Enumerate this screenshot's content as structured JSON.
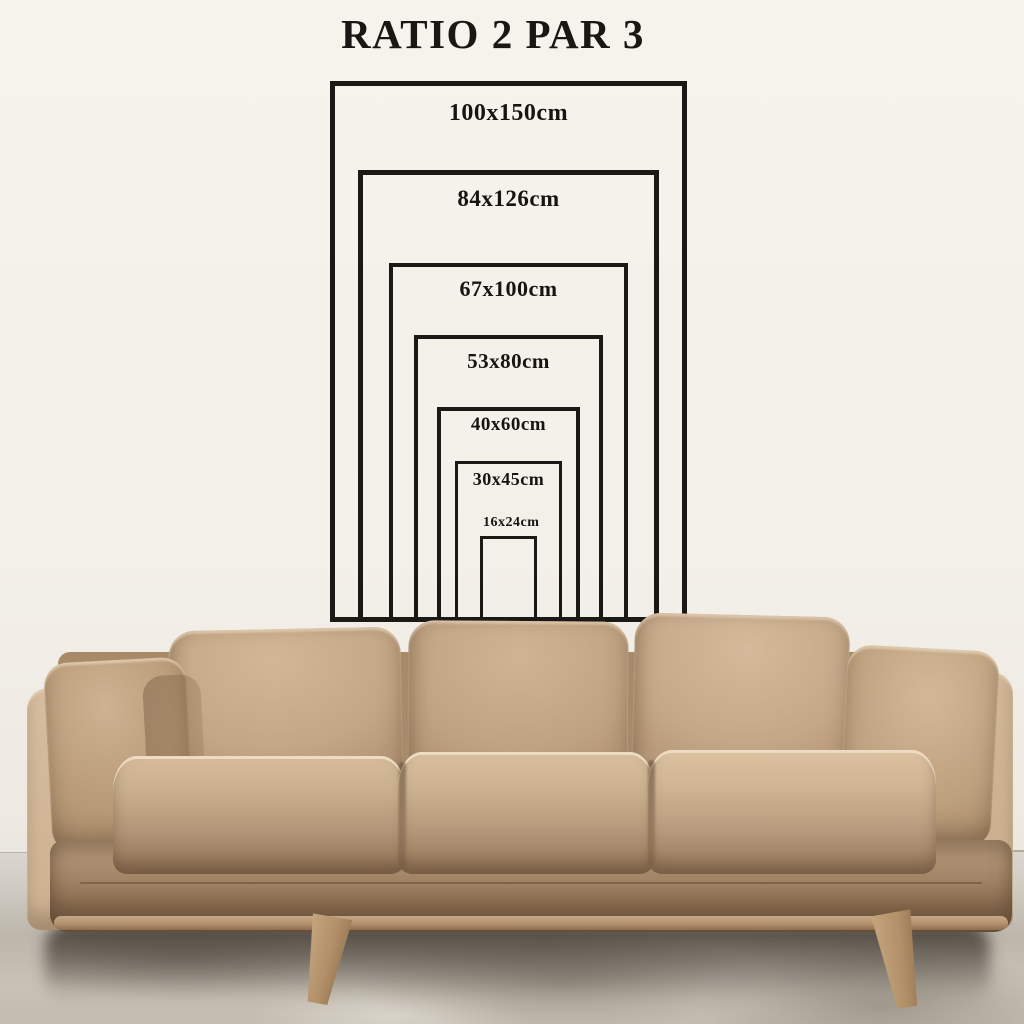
{
  "title": "RATIO 2 PAR 3",
  "diagram": {
    "unit": "cm",
    "aspect_ratio": "2:3",
    "line_color": "#1b1916",
    "sizes": [
      {
        "label": "100x150cm",
        "width_cm": 100,
        "height_cm": 150
      },
      {
        "label": "84x126cm",
        "width_cm": 84,
        "height_cm": 126
      },
      {
        "label": "67x100cm",
        "width_cm": 67,
        "height_cm": 100
      },
      {
        "label": "53x80cm",
        "width_cm": 53,
        "height_cm": 80
      },
      {
        "label": "40x60cm",
        "width_cm": 40,
        "height_cm": 60
      },
      {
        "label": "30x45cm",
        "width_cm": 30,
        "height_cm": 45
      },
      {
        "label": "16x24cm",
        "width_cm": 16,
        "height_cm": 24
      }
    ]
  },
  "scene": {
    "wall_color": "#f3efe9",
    "floor_color": "#c4beb2",
    "sofa_leather_color": "#c2a685",
    "diagram_text_color": "#1b1916"
  }
}
